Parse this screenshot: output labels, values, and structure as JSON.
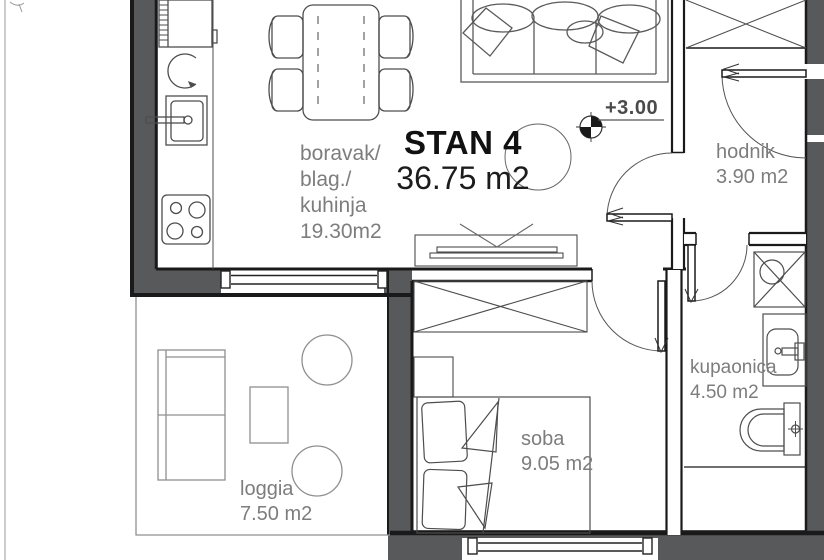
{
  "apartment": {
    "title": "STAN 4",
    "area": "36.75 m2",
    "elevation_label": "+3.00"
  },
  "rooms": {
    "living": {
      "line1": "boravak/",
      "line2": "blag./",
      "line3": "kuhinja",
      "line4": "19.30m2"
    },
    "hallway": {
      "name": "hodnik",
      "area": "3.90 m2"
    },
    "bathroom": {
      "name": "kupaonica",
      "area": "4.50 m2"
    },
    "bedroom": {
      "name": "soba",
      "area": "9.05 m2"
    },
    "loggia": {
      "name": "loggia",
      "area": "7.50 m2"
    }
  },
  "colors": {
    "wall_fill": "#58595b",
    "outline": "#1a1a1a",
    "furniture_line": "#4d4d4d",
    "loggia_line": "#8f8f8f",
    "label_text": "#7d7d7d",
    "title_text": "#111111"
  }
}
